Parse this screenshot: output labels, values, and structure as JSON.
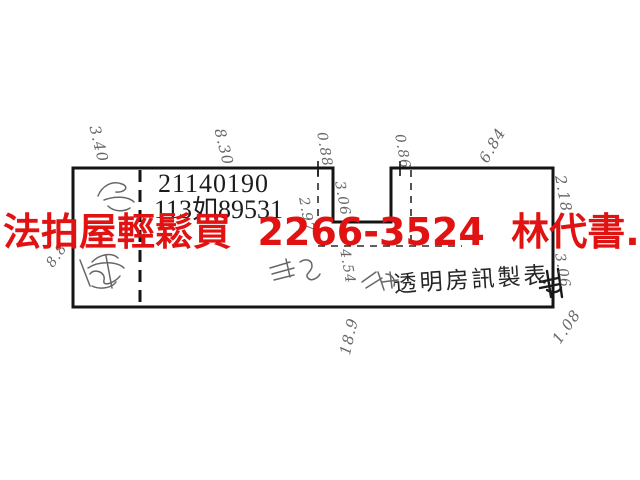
{
  "colors": {
    "background": "#ffffff",
    "ink": "#1c1c1c",
    "pencil": "#4d4d4d",
    "watermark_red": "#e01212"
  },
  "watermark": {
    "text": "法拍屋輕鬆買  2266-3524  林代書.林經理"
  },
  "plan": {
    "parcel_number": "21140190",
    "case_number": "113如89531",
    "publisher_label": "透明房訊製表"
  },
  "dimensions": [
    {
      "text": "3.40",
      "position": "top-left-segment"
    },
    {
      "text": "8.30",
      "position": "top-middle-segment"
    },
    {
      "text": "0.88",
      "position": "notch-left"
    },
    {
      "text": "0.86",
      "position": "notch-right"
    },
    {
      "text": "6.84",
      "position": "top-right-segment"
    },
    {
      "text": "2.18",
      "position": "right-upper"
    },
    {
      "text": "2.97",
      "position": "inside-near-notch-left"
    },
    {
      "text": "3.06",
      "position": "inside-notch"
    },
    {
      "text": "4.54",
      "position": "inside-lower-middle"
    },
    {
      "text": "3.06",
      "position": "right-lower"
    },
    {
      "text": "1.08",
      "position": "bottom-right-outside"
    },
    {
      "text": "8.8",
      "position": "left-outside"
    },
    {
      "text": "18.9",
      "position": "bottom-middle-outside"
    }
  ]
}
